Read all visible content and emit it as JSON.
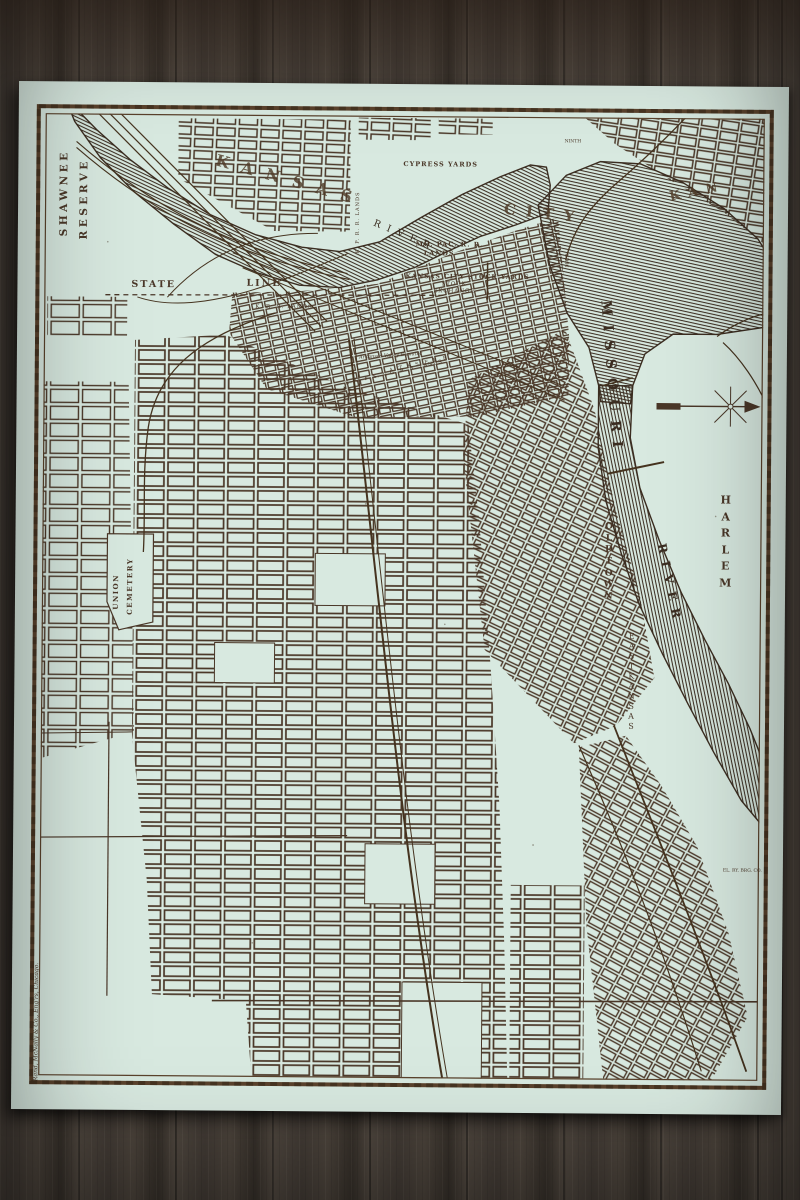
{
  "print": {
    "title_letters": {
      "kansas": "KANSAS",
      "city": "CITY",
      "kan": "KAN"
    },
    "rivers": {
      "missouri_name": "MISSOURI",
      "missouri_word_river": "RIVER",
      "kaw_word_river": "RIVER"
    },
    "places": {
      "shawnee": "SHAWNEE",
      "reserve": "RESERVE",
      "harlem": "HARLEM",
      "old_town": "OLD TOWN",
      "east_kansas": "EAST KANSAS",
      "union": "UNION",
      "cemetery": "CEMETERY",
      "state": "STATE",
      "line": "LINE"
    },
    "features": {
      "cypress_yards": "CYPRESS YARDS",
      "mo_pac_rr": "MO. PAC. R. R.",
      "mo_pac_lands": "LANDS",
      "stock_yards": "KANSAS CITY STOCK YARDS",
      "stock": "STOCK",
      "exchange": "EXCHANGE",
      "k_rr_lands": "K. R. R. LANDS",
      "kp_rr_lands": "K. P. R. R. LANDS",
      "atsf_rr": "A. T. & S. F. R. R.",
      "kcfsg_rr": "K. C. F. S. & G. R. R. LANDS",
      "elevator": "Arkansas Valley Elevator",
      "el_ry": "EL. RY. BRG. CO.",
      "ninth_st": "NINTH",
      "main_st": "MAIN"
    },
    "imprint": "Rand, McNally & Co., Eng'rs, Chicago.",
    "colors": {
      "paper": "#d8e9e0",
      "ink": "#4a3728",
      "frame": "#5a422c",
      "wood": "#474039"
    },
    "icons": {
      "compass": "north-arrow"
    }
  }
}
